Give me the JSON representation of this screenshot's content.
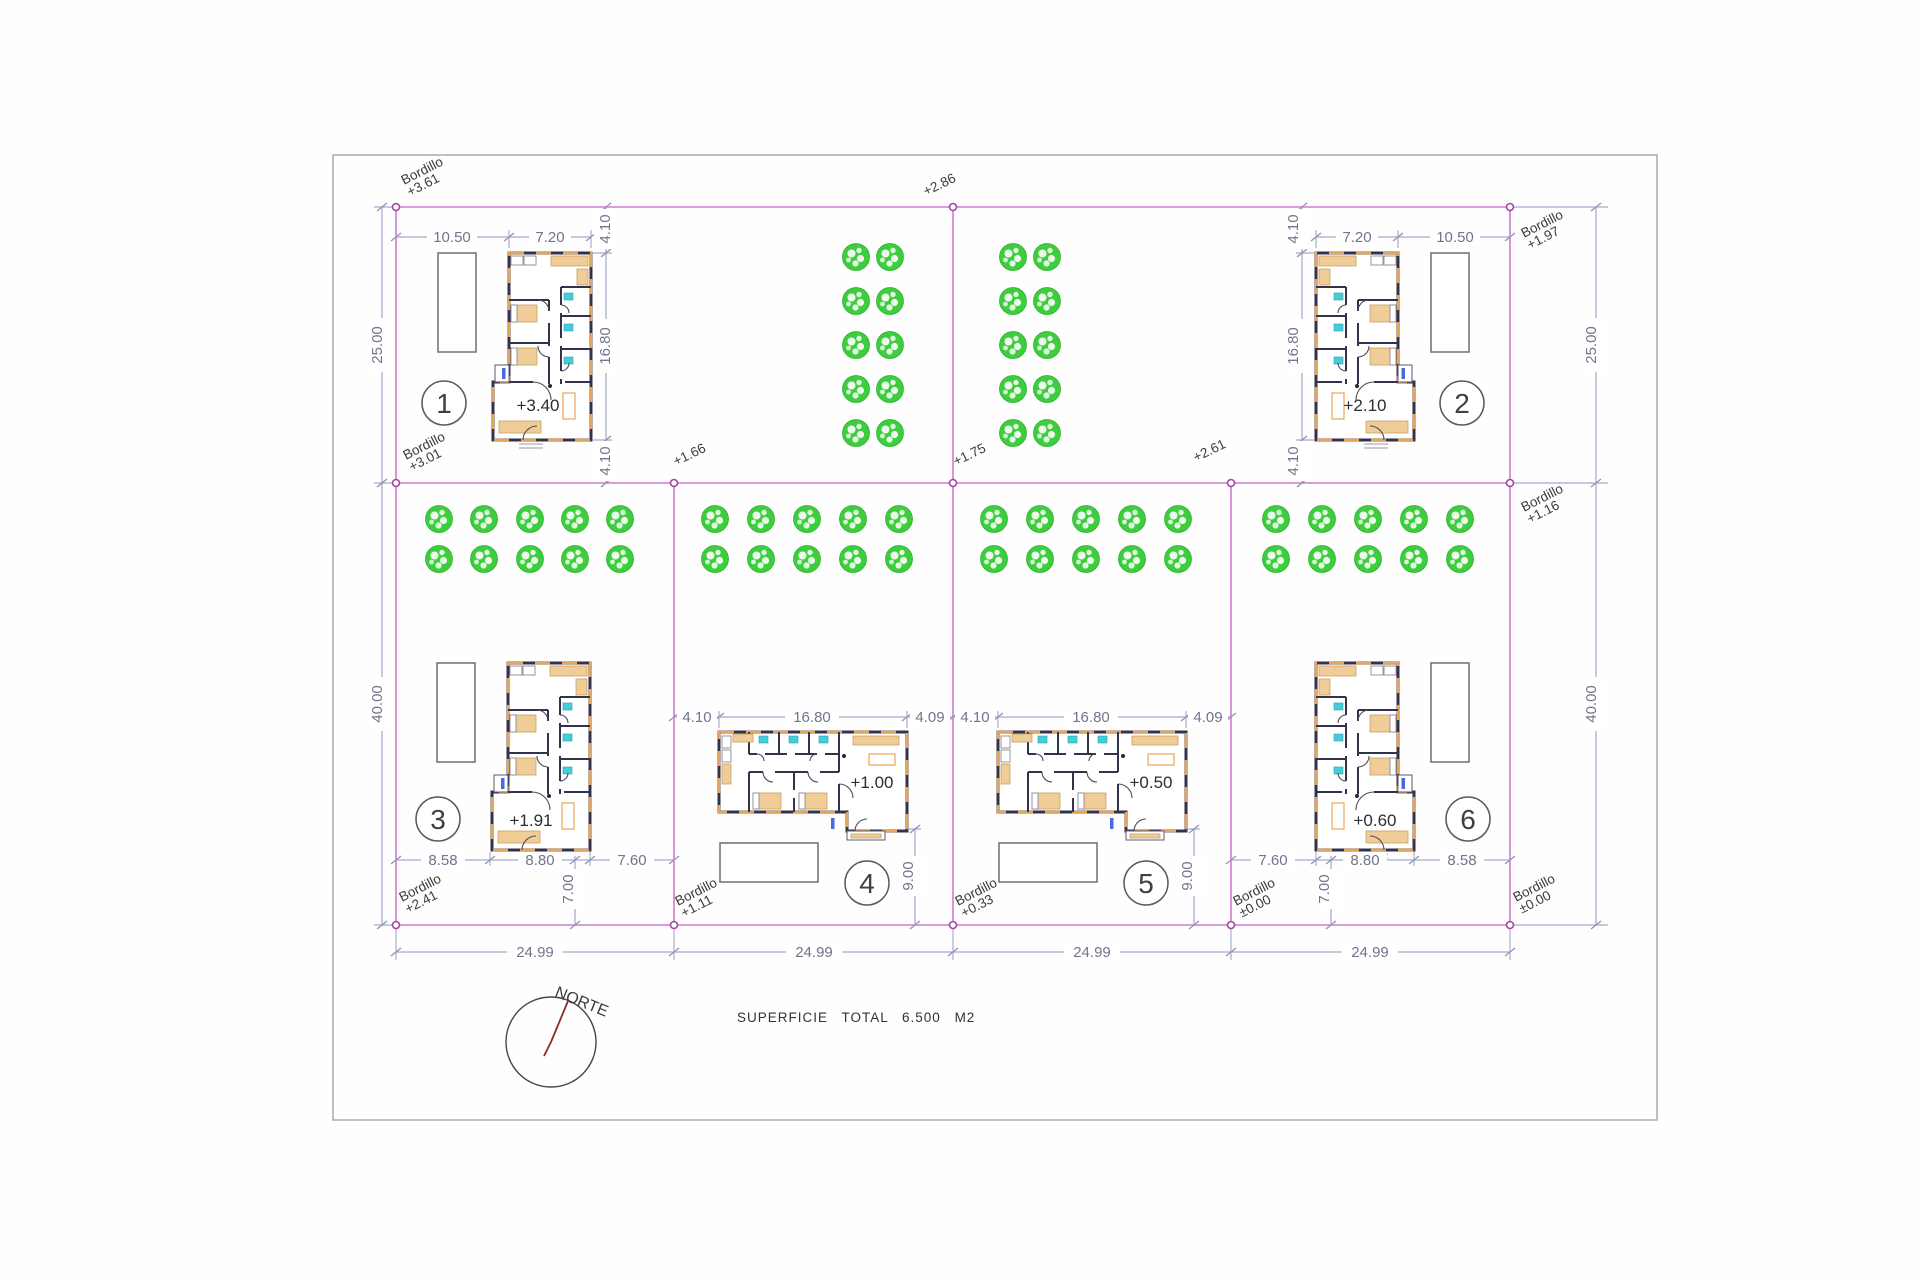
{
  "colors": {
    "boundary": "#d07ad0",
    "dim-line": "#8f96bb",
    "dim-text": "#70748c",
    "wall": "#32324d",
    "accent": "#e8a558",
    "tan": "#f0cc96",
    "fixture": "#45cdd8",
    "tree": "#3ecd3e",
    "node": "#a344a3",
    "text": "#3b3b3b",
    "border": "#a0a6ad",
    "needle": "#8b2a2a",
    "blue": "#4a6ae0"
  },
  "sheet": {
    "total_area_label": "SUPERFICIE TOTAL 6.500 M2",
    "north_label": "NORTE"
  },
  "spot_elevations": {
    "top_center": "+2.86",
    "mid_1": "+1.66",
    "mid_2": "+1.75",
    "mid_3": "+2.61"
  },
  "bordillo": {
    "word": "Bordillo",
    "top_left": "+3.61",
    "top_right": "+1.97",
    "mid_left": "+3.01",
    "mid_right": "+1.16",
    "bottom_1": "+2.41",
    "bottom_2": "+1.11",
    "bottom_3": "+0.33",
    "bottom_4": "±0.00",
    "bottom_5": "±0.00"
  },
  "outer_dimensions": {
    "bottom": [
      "24.99",
      "24.99",
      "24.99",
      "24.99"
    ],
    "left_top": "25.00",
    "left_bottom": "40.00",
    "right_top": "25.00",
    "right_bottom": "40.00"
  },
  "plots": {
    "p1": {
      "number": "1",
      "floor_level": "+3.40",
      "top_dims": [
        "10.50",
        "7.20"
      ],
      "side_dims": [
        "4.10",
        "16.80",
        "4.10"
      ]
    },
    "p2": {
      "number": "2",
      "floor_level": "+2.10",
      "top_dims": [
        "7.20",
        "10.50"
      ],
      "side_dims": [
        "4.10",
        "16.80",
        "4.10"
      ]
    },
    "p3": {
      "number": "3",
      "floor_level": "+1.91",
      "bottom_dims": [
        "8.58",
        "8.80",
        "7.60"
      ],
      "below_dim": "7.00"
    },
    "p4": {
      "number": "4",
      "floor_level": "+1.00",
      "mid_dims": [
        "4.10",
        "16.80",
        "4.09"
      ],
      "below_dim": "9.00"
    },
    "p5": {
      "number": "5",
      "floor_level": "+0.50",
      "mid_dims": [
        "4.10",
        "16.80",
        "4.09"
      ],
      "below_dim": "9.00"
    },
    "p6": {
      "number": "6",
      "floor_level": "+0.60",
      "bottom_dims": [
        "7.60",
        "8.80",
        "8.58"
      ],
      "below_dim": "7.00"
    }
  },
  "trees": {
    "radius": 13.5,
    "groups": [
      {
        "name": "orchard-top-left",
        "cols": [
          856,
          890
        ],
        "rows": [
          257,
          301,
          345,
          389,
          433
        ]
      },
      {
        "name": "orchard-top-right",
        "cols": [
          1013,
          1047
        ],
        "rows": [
          257,
          301,
          345,
          389,
          433
        ]
      },
      {
        "name": "orchard-plot-3",
        "cols": [
          439,
          484,
          530,
          575,
          620
        ],
        "rows": [
          519,
          559
        ]
      },
      {
        "name": "orchard-plot-4",
        "cols": [
          715,
          761,
          807,
          853,
          899
        ],
        "rows": [
          519,
          559
        ]
      },
      {
        "name": "orchard-plot-5",
        "cols": [
          994,
          1040,
          1086,
          1132,
          1178
        ],
        "rows": [
          519,
          559
        ]
      },
      {
        "name": "orchard-plot-6",
        "cols": [
          1276,
          1322,
          1368,
          1414,
          1460
        ],
        "rows": [
          519,
          559
        ]
      }
    ]
  }
}
